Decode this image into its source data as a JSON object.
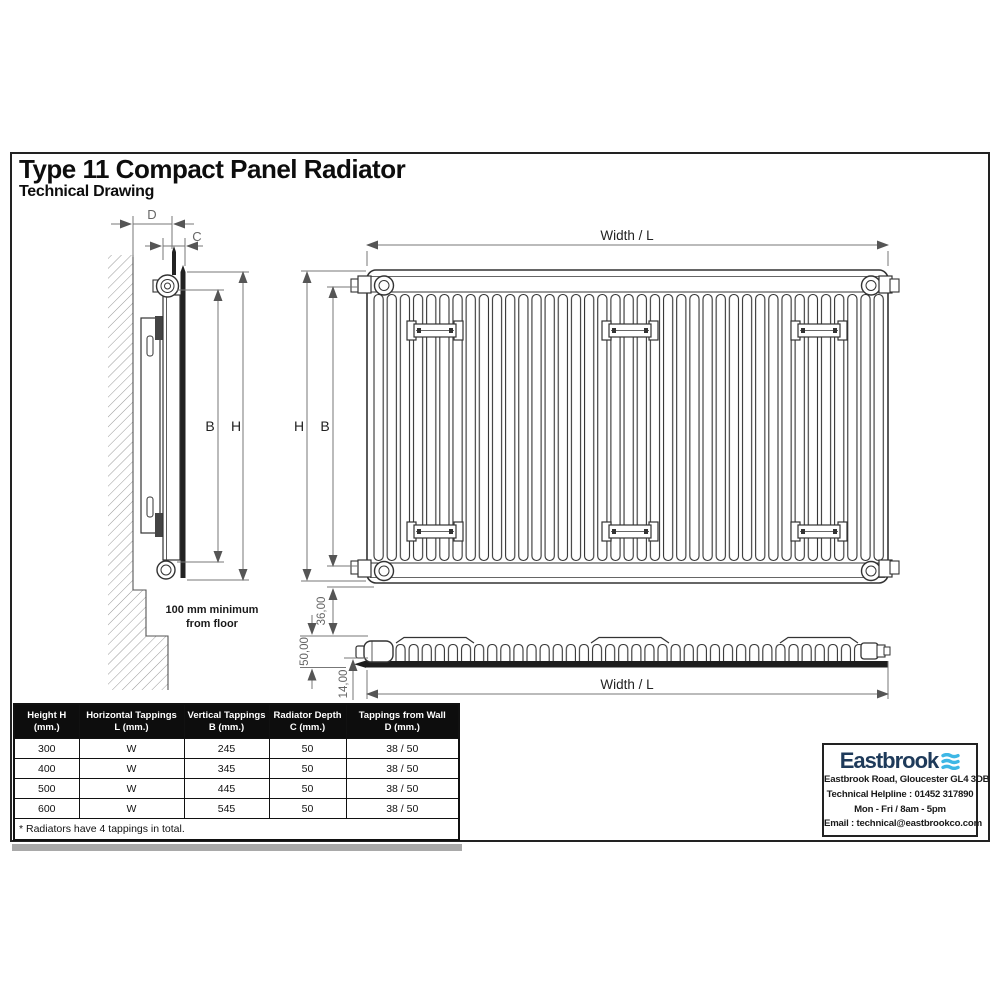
{
  "page": {
    "title": "Type 11 Compact Panel Radiator",
    "subtitle": "Technical Drawing"
  },
  "drawing": {
    "labels": {
      "dim_d": "D",
      "dim_c": "C",
      "side_b": "B",
      "side_h": "H",
      "front_h": "H",
      "front_b": "B",
      "width_top": "Width / L",
      "width_bottom": "Width / L",
      "floor_note_line1": "100 mm minimum",
      "floor_note_line2": "from floor",
      "dim_36": "36,00",
      "dim_50": "50,00",
      "dim_14": "14,00"
    }
  },
  "table": {
    "header_bg": "#0d0d0d",
    "headers": [
      {
        "line1": "Height H",
        "line2": "(mm.)"
      },
      {
        "line1": "Horizontal Tappings",
        "line2": "L (mm.)"
      },
      {
        "line1": "Vertical Tappings",
        "line2": "B (mm.)"
      },
      {
        "line1": "Radiator Depth",
        "line2": "C (mm.)"
      },
      {
        "line1": "Tappings from Wall",
        "line2": "D (mm.)"
      }
    ],
    "rows": [
      [
        "300",
        "W",
        "245",
        "50",
        "38 / 50"
      ],
      [
        "400",
        "W",
        "345",
        "50",
        "38 / 50"
      ],
      [
        "500",
        "W",
        "445",
        "50",
        "38 / 50"
      ],
      [
        "600",
        "W",
        "545",
        "50",
        "38 / 50"
      ]
    ],
    "footnote": "* Radiators have 4 tappings in total."
  },
  "contact": {
    "brand": "Eastbrook",
    "brand_color": "#1e3a5a",
    "wave_color": "#3eb7e5",
    "address": "Eastbrook Road, Gloucester GL4 3DB",
    "helpline": "Technical Helpline : 01452 317890",
    "hours": "Mon - Fri / 8am - 5pm",
    "email": "Email : technical@eastbrookco.com"
  }
}
